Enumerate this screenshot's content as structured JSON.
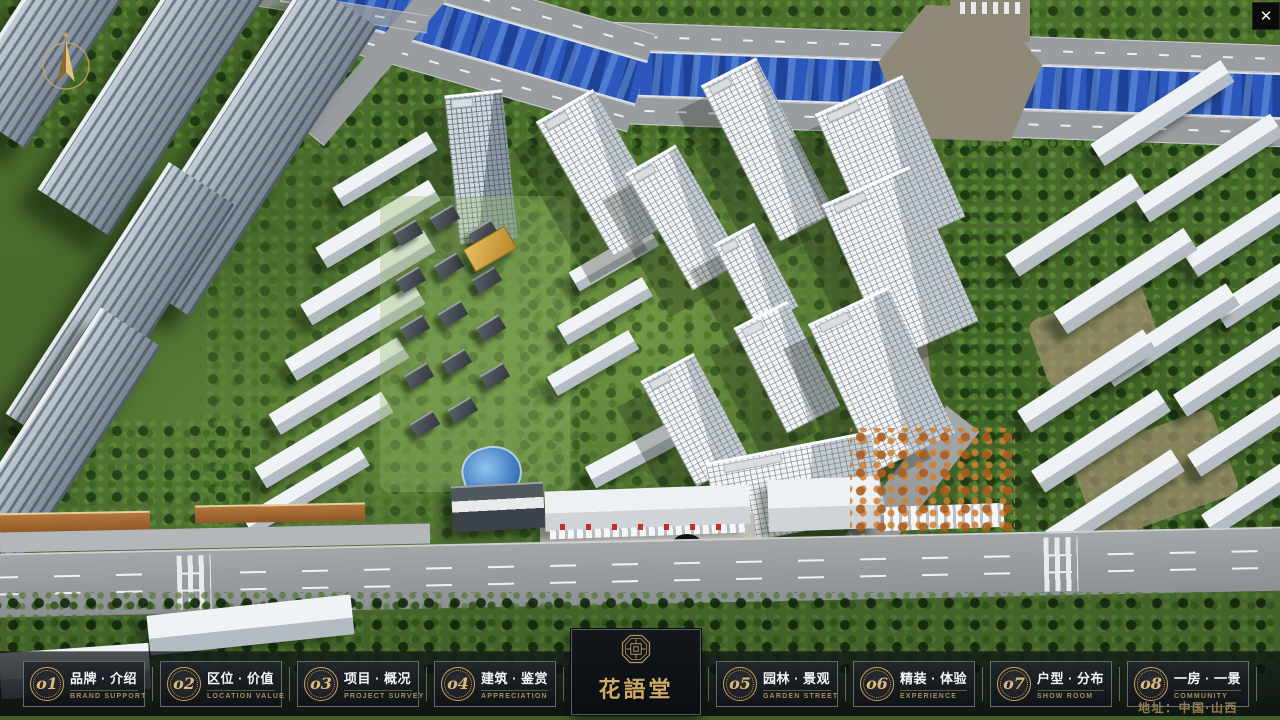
{
  "window": {
    "close_label": "✕"
  },
  "logo": {
    "title": "花語堂",
    "tagline": "· · · · · · · · · ·"
  },
  "menu": {
    "items": [
      {
        "num": "o1",
        "label": "品牌 · 介绍",
        "sub": "BRAND SUPPORT"
      },
      {
        "num": "o2",
        "label": "区位 · 价值",
        "sub": "LOCATION VALUE"
      },
      {
        "num": "o3",
        "label": "项目 · 概况",
        "sub": "PROJECT SURVEY"
      },
      {
        "num": "o4",
        "label": "建筑 · 鉴赏",
        "sub": "APPRECIATION"
      },
      {
        "num": "o5",
        "label": "园林 · 景观",
        "sub": "GARDEN STREET"
      },
      {
        "num": "o6",
        "label": "精装 · 体验",
        "sub": "EXPERIENCE"
      },
      {
        "num": "o7",
        "label": "户型 · 分布",
        "sub": "SHOW ROOM"
      },
      {
        "num": "o8",
        "label": "一房 · 一景",
        "sub": "COMMUNITY"
      }
    ]
  },
  "footer": {
    "address": "地址：中国·山西"
  }
}
